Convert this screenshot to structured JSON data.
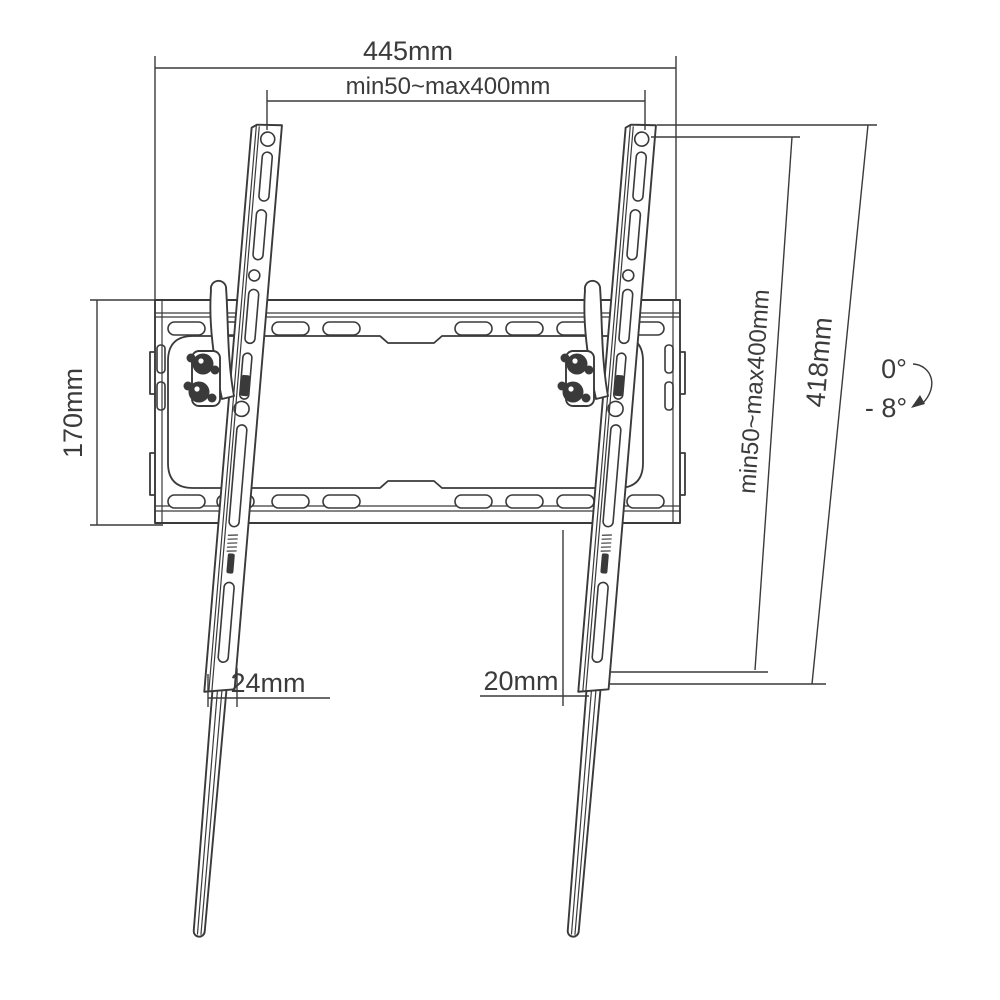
{
  "diagram": {
    "subject": "Tilting TV wall mount bracket - dimensional drawing, front view",
    "background": "#ffffff",
    "line_color": "#3a3a3a",
    "dimensions": {
      "top_width": "445mm",
      "top_hole_pitch": "min50~max400mm",
      "left_height": "170mm",
      "right_hole_pitch": "min50~max400mm",
      "right_length": "418mm",
      "tilt_from": "0°",
      "tilt_to": "- 8°",
      "bottom_left": "24mm",
      "bottom_right": "20mm"
    }
  }
}
